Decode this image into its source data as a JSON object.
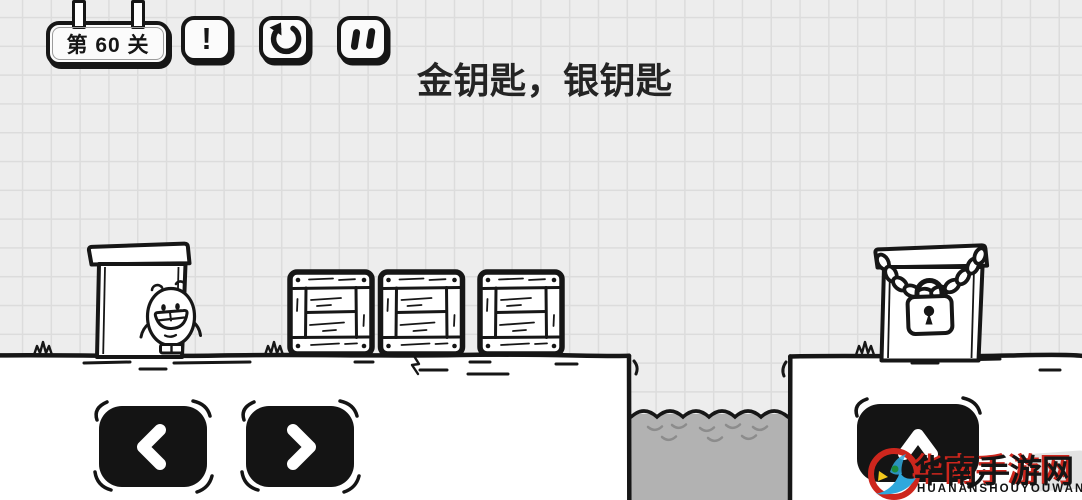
{
  "hud": {
    "level_label": "第 60 关",
    "hint_glyph": "!",
    "restart_icon": "counterclockwise-arrow",
    "pause_icon": "double-vertical-bars"
  },
  "puzzle": {
    "title": "金钥匙，银钥匙"
  },
  "controls": {
    "move_left_icon": "chevron-left",
    "move_right_icon": "chevron-right",
    "jump_icon": "chevron-up"
  },
  "scene": {
    "player": "egg-character",
    "left_object": "white-door",
    "crates_count": 3,
    "right_object": "chain-locked-box",
    "hazard": "water-pit",
    "grass_tufts": 3
  },
  "watermark": {
    "logo": "circular-bird-logo",
    "cn_text": "华南手游网",
    "en_text": "HUANANSHOUYOUWANG"
  },
  "colors": {
    "paper": "#ededed",
    "grid_line": "#dcdcdc",
    "ink": "#161616",
    "water": "#b2b2b2",
    "water_wave": "#8c8c8c",
    "button_black": "#141414",
    "white": "#ffffff",
    "watermark_red": "#cd261d",
    "watermark_blue": "#2fa8dc",
    "watermark_yellow": "#f4c81c",
    "watermark_green": "#1c8c3c"
  }
}
